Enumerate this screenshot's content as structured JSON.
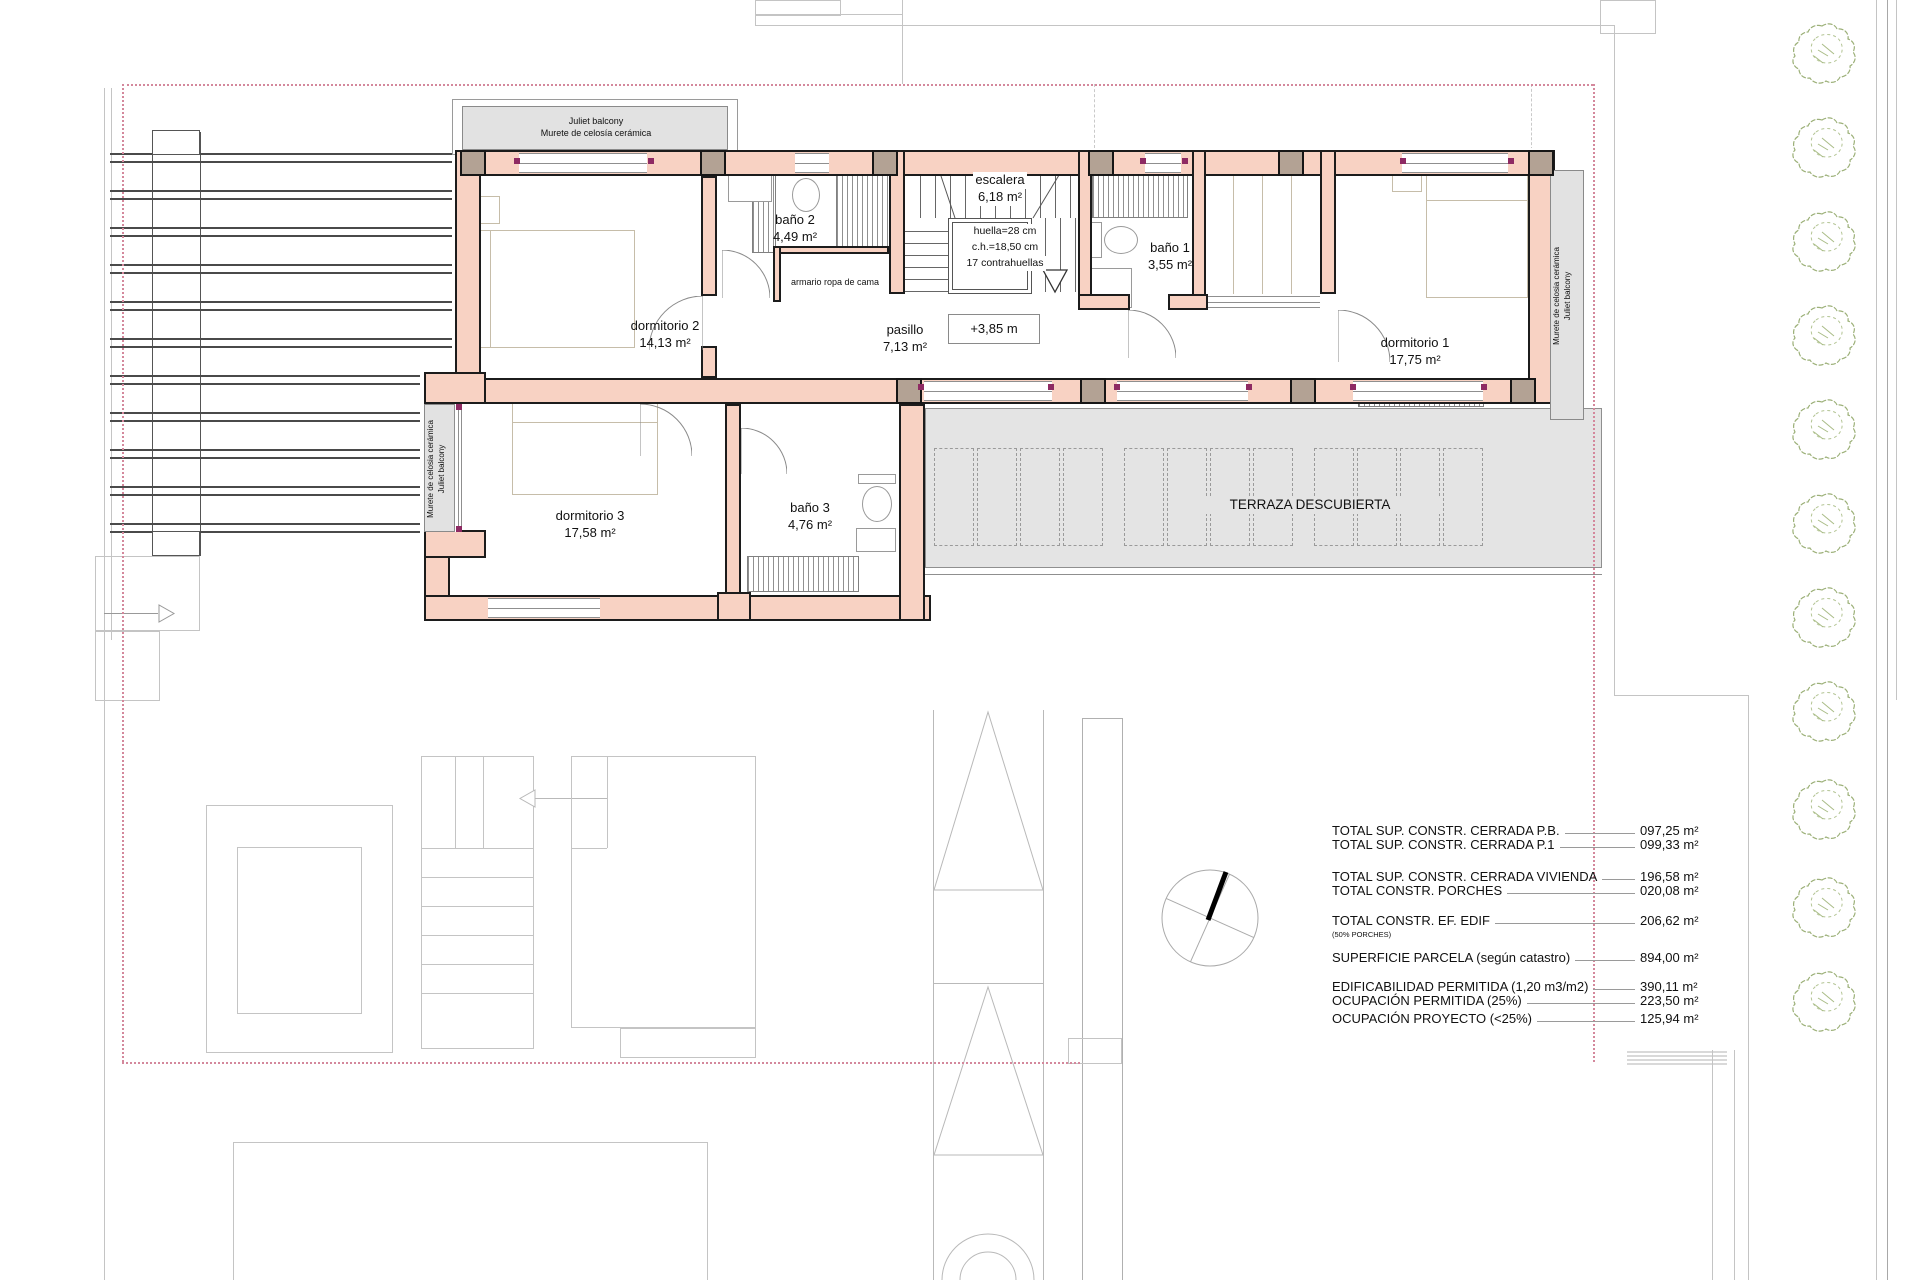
{
  "plan": {
    "level_mark": "+3,85 m",
    "rooms": {
      "dormitorio2": {
        "name": "dormitorio 2",
        "area": "14,13 m²"
      },
      "bano2": {
        "name": "baño 2",
        "area": "4,49 m²"
      },
      "escalera": {
        "name": "escalera",
        "area": "6,18 m²"
      },
      "pasillo": {
        "name": "pasillo",
        "area": "7,13 m²"
      },
      "bano1": {
        "name": "baño 1",
        "area": "3,55 m²"
      },
      "dormitorio1": {
        "name": "dormitorio 1",
        "area": "17,75 m²"
      },
      "dormitorio3": {
        "name": "dormitorio 3",
        "area": "17,58 m²"
      },
      "bano3": {
        "name": "baño 3",
        "area": "4,76 m²"
      }
    },
    "stair_note": [
      "huella=28 cm",
      "c.h.=18,50 cm",
      "17 contrahuellas"
    ],
    "closet_label": "armario ropa de cama",
    "terrace_label": "TERRAZA DESCUBIERTA",
    "balcony_top": [
      "Juliet balcony",
      "Murete de celosía cerámica"
    ],
    "balcony_side": [
      "Murete de celosia cerámica",
      "Juliet balcony"
    ]
  },
  "areas_table": {
    "rows": [
      {
        "label": "TOTAL SUP. CONSTR. CERRADA P.B.",
        "value": "097,25 m²"
      },
      {
        "label": "TOTAL SUP. CONSTR. CERRADA P.1",
        "value": "099,33 m²"
      },
      {
        "label": "TOTAL SUP. CONSTR. CERRADA VIVIENDA",
        "value": "196,58 m²"
      },
      {
        "label": "TOTAL  CONSTR. PORCHES",
        "value": "020,08 m²"
      },
      {
        "label": "TOTAL  CONSTR.  EF. EDIF",
        "value": "206,62 m²"
      },
      {
        "label": "SUPERFICIE PARCELA (según catastro)",
        "value": "894,00 m²"
      },
      {
        "label": "EDIFICABILIDAD PERMITIDA (1,20 m3/m2)",
        "value": "390,11 m²"
      },
      {
        "label": "OCUPACIÓN PERMITIDA (25%)",
        "value": "223,50 m²"
      },
      {
        "label": "OCUPACIÓN PROYECTO (<25%)",
        "value": "125,94 m²"
      }
    ],
    "note": "(50% PORCHES)"
  },
  "colors": {
    "wall_fill": "#f8d2c3",
    "wall_line": "#1c1c1c",
    "column_fill": "#b3a294",
    "boundary_pink": "#d4889c",
    "terrace_gray": "#e4e4e4",
    "marker_magenta": "#8e2a63",
    "tree_green": "#9cb078"
  }
}
